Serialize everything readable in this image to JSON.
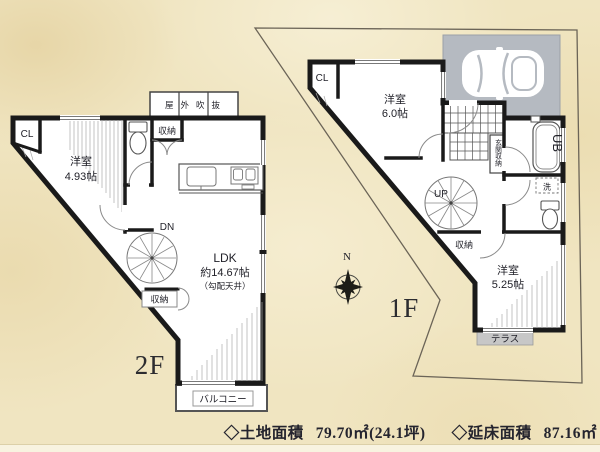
{
  "colors": {
    "background": "#f0e5c1",
    "wall": "#1a1a1a",
    "carport": "#b5bac1",
    "terrace": "#c7c7c7",
    "footer_text": "#24242e"
  },
  "floor2": {
    "floor_label": "2F",
    "closet_label": "CL",
    "bedroom": {
      "name": "洋室",
      "size": "4.93帖"
    },
    "storage_top": "収納",
    "outdoor_void": "屋外吹抜",
    "stairs_label": "DN",
    "ldk": {
      "name": "LDK",
      "size": "約14.67帖",
      "note": "（勾配天井）"
    },
    "storage_mid": "収納",
    "balcony": "バルコニー"
  },
  "floor1": {
    "floor_label": "1F",
    "closet_label": "CL",
    "bedroom_north": {
      "name": "洋室",
      "size": "6.0帖"
    },
    "entrance_storage": "玄関収納",
    "unit_bath": "UB",
    "laundry": "洗",
    "stairs_label": "UP",
    "storage": "収納",
    "bedroom_south": {
      "name": "洋室",
      "size": "5.25帖"
    },
    "terrace": "テラス"
  },
  "compass": {
    "north": "N"
  },
  "footer": {
    "land": {
      "label": "◇土地面積",
      "value": "79.70㎡(24.1坪)"
    },
    "total_floor": {
      "label": "◇延床面積",
      "value": "87.16㎡"
    }
  }
}
